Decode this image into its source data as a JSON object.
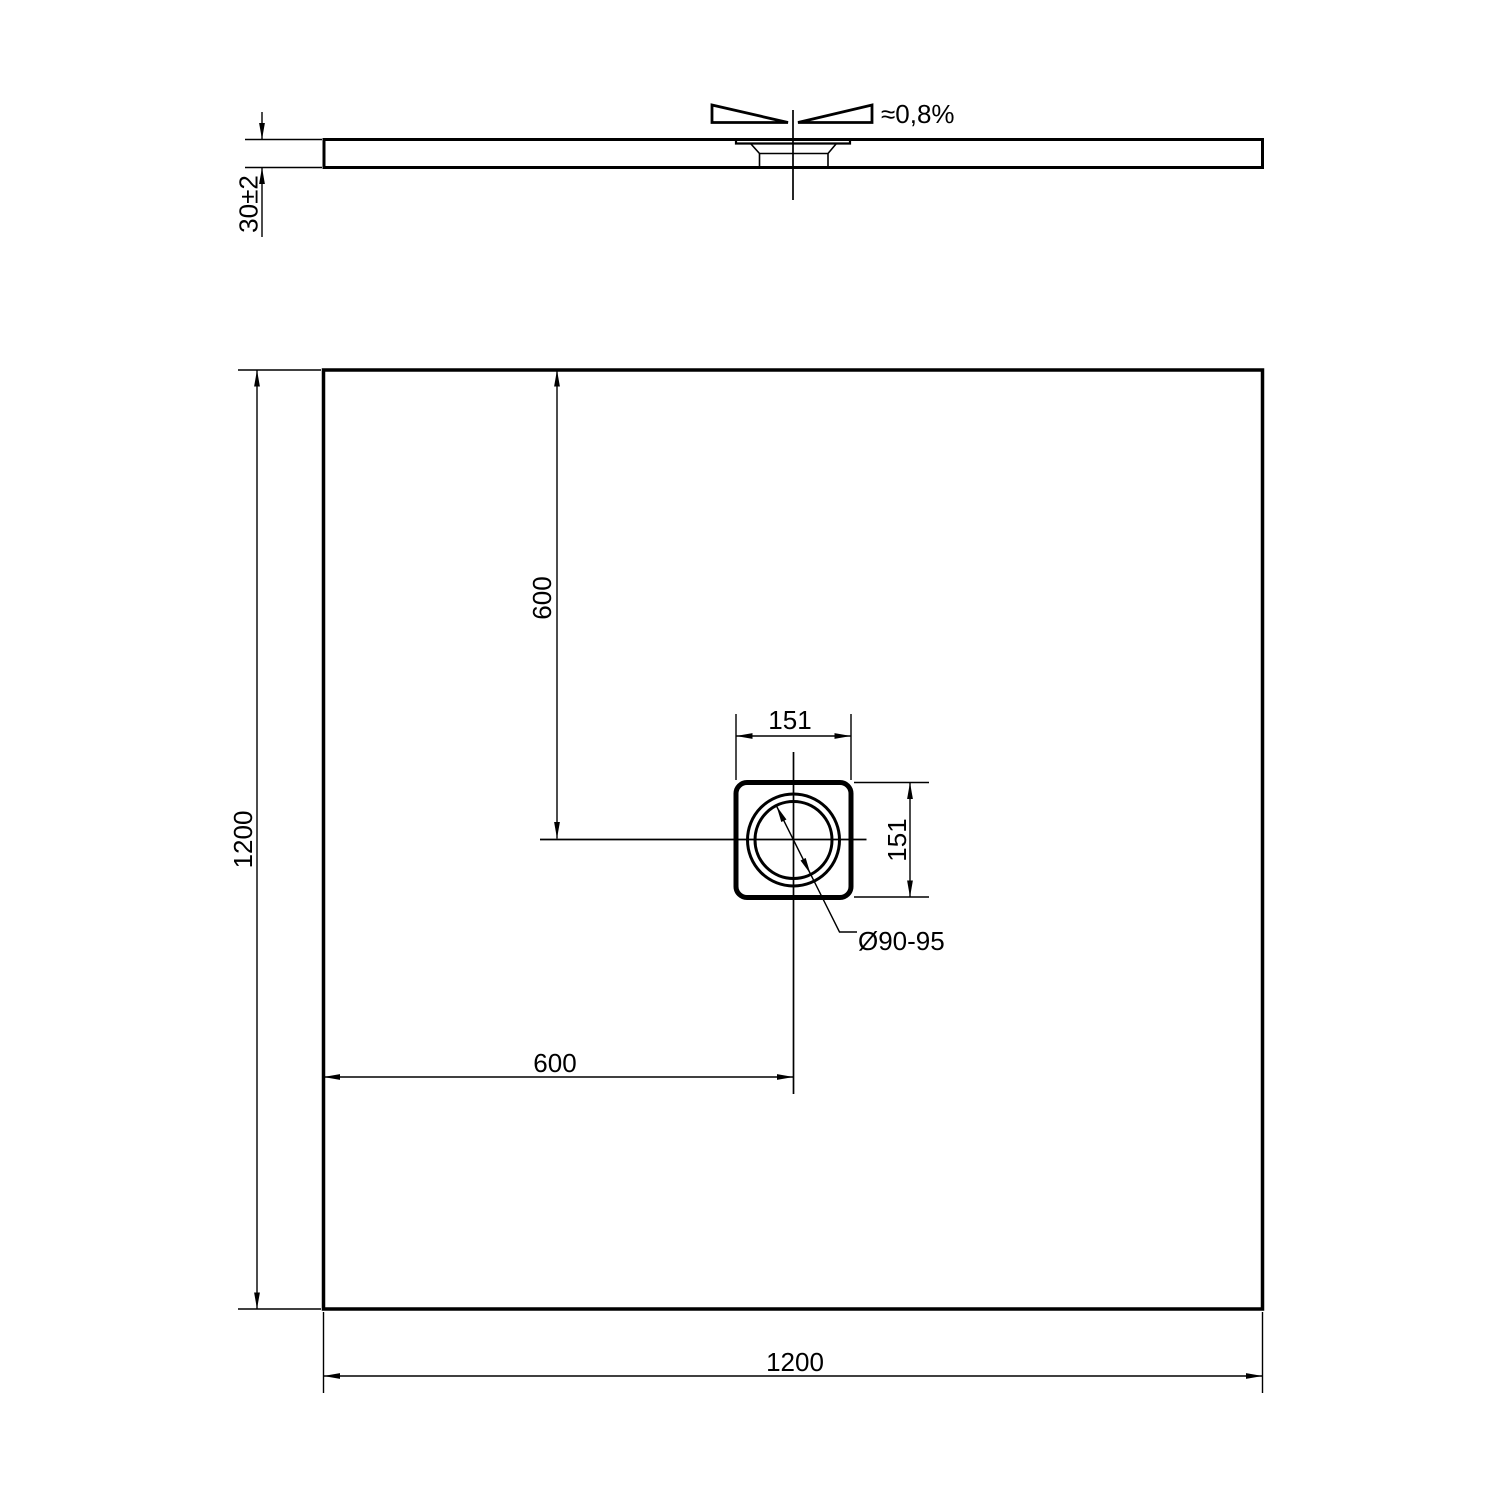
{
  "side_view": {
    "slope_label": "≈0,8%",
    "thickness_dim": "30±2"
  },
  "plan_view": {
    "overall_width_dim": "1200",
    "overall_depth_dim": "1200",
    "drain_offset_horizontal_dim": "600",
    "drain_offset_vertical_dim": "600",
    "drain_flange_width_dim": "151",
    "drain_flange_height_dim": "151",
    "drain_diameter_label": "Ø90-95"
  },
  "colors": {
    "line": "#000000",
    "background": "#ffffff"
  }
}
